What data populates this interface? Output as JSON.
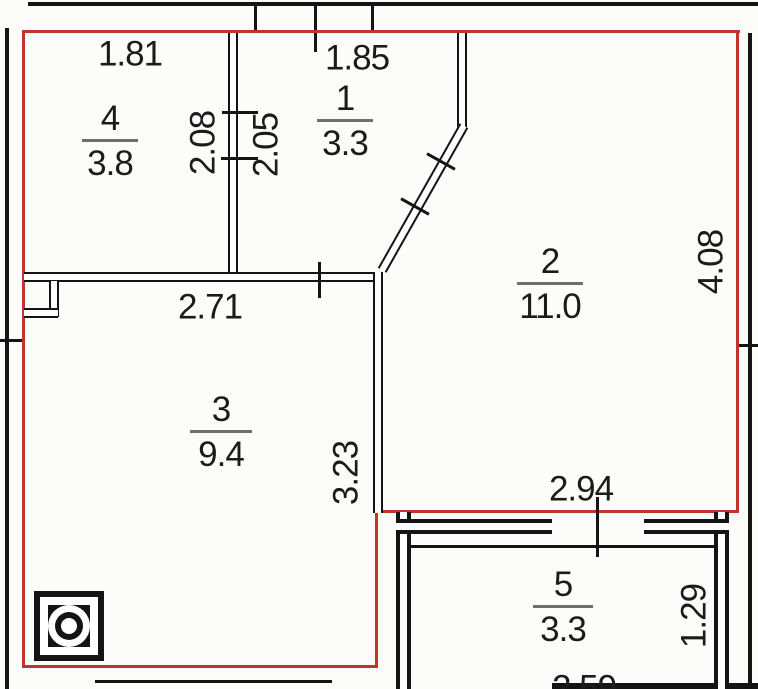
{
  "title": "apartment-floor-plan",
  "colors": {
    "outline_red": "#c2342a",
    "wall_black": "#141414",
    "background": "#fcfcfa"
  },
  "rooms": {
    "r1": {
      "number": "1",
      "area": "3.3"
    },
    "r2": {
      "number": "2",
      "area": "11.0"
    },
    "r3": {
      "number": "3",
      "area": "9.4"
    },
    "r4": {
      "number": "4",
      "area": "3.8"
    },
    "r5": {
      "number": "5",
      "area": "3.3"
    }
  },
  "dimensions": {
    "d181": "1.81",
    "d185": "1.85",
    "d208": "2.08",
    "d205": "2.05",
    "d271": "2.71",
    "d408": "4.08",
    "d323": "3.23",
    "d294": "2.94",
    "d129": "1.29",
    "d259": "2.59"
  },
  "icons": {
    "shaft": "ventilation-shaft-icon"
  }
}
